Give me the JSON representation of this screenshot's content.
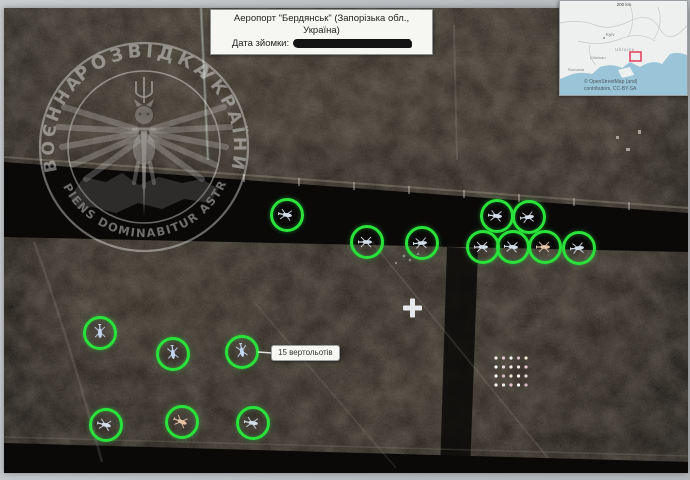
{
  "header": {
    "title": "Аеропорт \"Бердянськ\" (Запорізька обл., Україна)",
    "date_label": "Дата зйомки:"
  },
  "stamp": {
    "word_left": "ВОЄННА",
    "word_top": "РОЗВІДКА",
    "word_right": "УКРАЇНИ",
    "motto": "✦ SAPIENS DOMINABITUR ASTRIS ✦"
  },
  "annotation": {
    "label": "15 вертольотів"
  },
  "inset_map": {
    "scale_label": "200 km",
    "city": "Kyiv",
    "country": "Ukraine",
    "city2": "Chisinau",
    "country2": "Romania",
    "attribution_line1": "© OpenStreetMap (and)",
    "attribution_line2": "contributors, CC-BY-SA",
    "marker_color": "#e23a5a"
  },
  "markers": {
    "ring_color": "#2ae33a",
    "default_heli_color": "#d3dde9",
    "circles": [
      {
        "x": 287,
        "y": 215,
        "rot": 10
      },
      {
        "x": 367,
        "y": 242,
        "rot": 0
      },
      {
        "x": 422,
        "y": 243,
        "rot": -4
      },
      {
        "x": 497,
        "y": 216,
        "rot": 6
      },
      {
        "x": 529,
        "y": 217,
        "rot": -8
      },
      {
        "x": 483,
        "y": 247,
        "rot": 0
      },
      {
        "x": 513,
        "y": 247,
        "rot": 5
      },
      {
        "x": 545,
        "y": 247,
        "rot": 0,
        "color": "#e4c3a6"
      },
      {
        "x": 579,
        "y": 248,
        "rot": -6
      },
      {
        "x": 100,
        "y": 333,
        "rot": 88,
        "color": "#c4d6f2"
      },
      {
        "x": 173,
        "y": 354,
        "rot": 84,
        "color": "#c4d6f2"
      },
      {
        "x": 242,
        "y": 352,
        "rot": 80,
        "color": "#c4d6f2"
      },
      {
        "x": 106,
        "y": 425,
        "rot": 14
      },
      {
        "x": 182,
        "y": 422,
        "rot": 22,
        "color": "#e4c3a6"
      },
      {
        "x": 253,
        "y": 423,
        "rot": 10
      }
    ]
  },
  "scene": {
    "storage_grid": {
      "x": 492,
      "y": 350,
      "cols": 5,
      "rows": 4,
      "dx": 7.5,
      "dy": 9,
      "colors": [
        "#f2f0ea",
        "#e7c6d1",
        "#ffffff",
        "#d8b8c8",
        "#f5ead8",
        "#ffffff",
        "#e8d8e0",
        "#f8f4ee"
      ]
    }
  }
}
